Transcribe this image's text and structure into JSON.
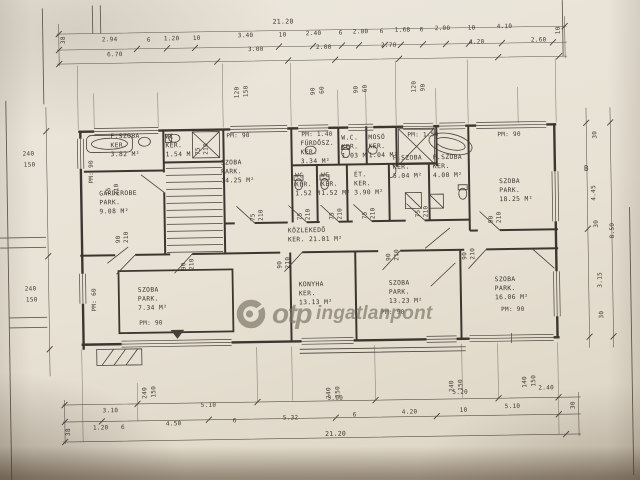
{
  "watermark": {
    "brand": "otp",
    "suffix": "ingatlanpont"
  },
  "plan": {
    "ink_color": "#3e3831",
    "paper_color": "#e8e2d5",
    "watermark_color": "#7b7565",
    "rooms": [
      {
        "name": "room-fszoba-382",
        "x": 112,
        "y": 129,
        "lines": [
          "F.SZOBA",
          "KER.",
          "3.82 M²"
        ]
      },
      {
        "name": "room-wc-154",
        "x": 167,
        "y": 130,
        "lines": [
          "WC",
          "KER.",
          "1.54 M"
        ]
      },
      {
        "name": "room-szoba-1425",
        "x": 222,
        "y": 157,
        "lines": [
          "SZOBA",
          "PARK.",
          "14.25 M²"
        ]
      },
      {
        "name": "room-garderobe",
        "x": 100,
        "y": 186,
        "lines": [
          "GARDEROBE",
          "PARK.",
          "9.08 M²"
        ]
      },
      {
        "name": "room-furdosz-334",
        "x": 302,
        "y": 139,
        "lines": [
          "FÜRDŐSZ.",
          "KER.",
          "3.34 M²"
        ]
      },
      {
        "name": "room-wc-103",
        "x": 343,
        "y": 134,
        "lines": [
          "W.C.",
          "KER.",
          "1.03 M"
        ]
      },
      {
        "name": "room-moso-104",
        "x": 370,
        "y": 134,
        "lines": [
          "MOSÓ",
          "KER.",
          "1.04 M²"
        ]
      },
      {
        "name": "room-fszoba-504",
        "x": 394,
        "y": 155,
        "lines": [
          "F.SZOBA",
          "KER.",
          "5.04 M²"
        ]
      },
      {
        "name": "room-fszoba-400",
        "x": 434,
        "y": 155,
        "lines": [
          "F.SZOBA",
          "KER.",
          "4.00 M²"
        ]
      },
      {
        "name": "room-szoba-1825",
        "x": 500,
        "y": 180,
        "lines": [
          "SZOBA",
          "PARK.",
          "18.25 M²"
        ]
      },
      {
        "name": "room-wc-152a",
        "x": 296,
        "y": 171,
        "lines": [
          "WC",
          "KER.",
          "1.52 M"
        ]
      },
      {
        "name": "room-wc-152b",
        "x": 322,
        "y": 171,
        "lines": [
          "WC",
          "KER.",
          "1.52 M²"
        ]
      },
      {
        "name": "room-et-390",
        "x": 355,
        "y": 171,
        "lines": [
          "ÉT.",
          "KER.",
          "3.90 M²"
        ]
      },
      {
        "name": "room-kozlekedo",
        "x": 288,
        "y": 226,
        "lines": [
          "KÖZLEKEDŐ",
          "KER. 21.01 M²"
        ]
      },
      {
        "name": "room-szoba-734",
        "x": 137,
        "y": 283,
        "lines": [
          "SZOBA",
          "PARK.",
          "7.34 M²"
        ]
      },
      {
        "name": "room-konyha",
        "x": 298,
        "y": 280,
        "lines": [
          "KONYHA",
          "KER.",
          "13.13 M²"
        ]
      },
      {
        "name": "room-szoba-1323",
        "x": 388,
        "y": 280,
        "lines": [
          "SZOBA",
          "PARK.",
          "13.23 M²"
        ]
      },
      {
        "name": "room-szoba-1606",
        "x": 494,
        "y": 278,
        "lines": [
          "SZOBA",
          "PARK.",
          "16.06 M²"
        ]
      }
    ],
    "dim_labels": [
      {
        "t": "21.20",
        "x": 276,
        "y": 17,
        "fs": 6.5
      },
      {
        "t": "38",
        "x": 63,
        "y": 40,
        "r": -90
      },
      {
        "t": "2.94",
        "x": 105,
        "y": 33
      },
      {
        "t": "6",
        "x": 150,
        "y": 34
      },
      {
        "t": "1.20",
        "x": 167,
        "y": 33
      },
      {
        "t": "10",
        "x": 196,
        "y": 33
      },
      {
        "t": "3.40",
        "x": 241,
        "y": 31
      },
      {
        "t": "10",
        "x": 282,
        "y": 31
      },
      {
        "t": "2.40",
        "x": 309,
        "y": 30
      },
      {
        "t": "6",
        "x": 342,
        "y": 30
      },
      {
        "t": "2.00",
        "x": 356,
        "y": 29
      },
      {
        "t": "6",
        "x": 383,
        "y": 29
      },
      {
        "t": "1.68",
        "x": 398,
        "y": 28
      },
      {
        "t": "6",
        "x": 423,
        "y": 28
      },
      {
        "t": "2.00",
        "x": 438,
        "y": 27
      },
      {
        "t": "10",
        "x": 471,
        "y": 27
      },
      {
        "t": "4.10",
        "x": 500,
        "y": 26
      },
      {
        "t": "10",
        "x": 558,
        "y": 38,
        "r": -90
      },
      {
        "t": "6.70",
        "x": 110,
        "y": 48
      },
      {
        "t": "3.00",
        "x": 251,
        "y": 45
      },
      {
        "t": "2.00",
        "x": 319,
        "y": 44
      },
      {
        "t": "2.70",
        "x": 384,
        "y": 43
      },
      {
        "t": "4.20",
        "x": 472,
        "y": 41
      },
      {
        "t": "2.60",
        "x": 534,
        "y": 40
      },
      {
        "t": "120",
        "x": 236,
        "y": 97,
        "r": -90
      },
      {
        "t": "150",
        "x": 245,
        "y": 96,
        "r": -90
      },
      {
        "t": "90",
        "x": 312,
        "y": 95,
        "r": -90
      },
      {
        "t": "60",
        "x": 321,
        "y": 94,
        "r": -90
      },
      {
        "t": "90",
        "x": 355,
        "y": 94,
        "r": -90
      },
      {
        "t": "60",
        "x": 364,
        "y": 93,
        "r": -90
      },
      {
        "t": "120",
        "x": 413,
        "y": 94,
        "r": -90
      },
      {
        "t": "90",
        "x": 422,
        "y": 93,
        "r": -90
      },
      {
        "t": "240",
        "x": 24,
        "y": 146
      },
      {
        "t": "150",
        "x": 25,
        "y": 157
      },
      {
        "t": "240",
        "x": 24,
        "y": 281
      },
      {
        "t": "150",
        "x": 25,
        "y": 292
      },
      {
        "t": "30",
        "x": 593,
        "y": 143,
        "r": -90
      },
      {
        "t": "B",
        "x": 585,
        "y": 168,
        "fs": 7.5
      },
      {
        "t": "4.45",
        "x": 591,
        "y": 205,
        "r": -90
      },
      {
        "t": "30",
        "x": 593,
        "y": 232,
        "r": -90
      },
      {
        "t": "8.50",
        "x": 609,
        "y": 243,
        "r": -90
      },
      {
        "t": "3.15",
        "x": 596,
        "y": 292,
        "r": -90
      },
      {
        "t": "30",
        "x": 597,
        "y": 323,
        "r": -90
      },
      {
        "t": "240",
        "x": 139,
        "y": 396,
        "r": -90
      },
      {
        "t": "150",
        "x": 148,
        "y": 395,
        "r": -90
      },
      {
        "t": "240",
        "x": 323,
        "y": 399,
        "r": -90
      },
      {
        "t": "150",
        "x": 332,
        "y": 398,
        "r": -90
      },
      {
        "t": "240",
        "x": 446,
        "y": 394,
        "r": -90
      },
      {
        "t": "150",
        "x": 455,
        "y": 393,
        "r": -90
      },
      {
        "t": "140",
        "x": 519,
        "y": 391,
        "r": -90
      },
      {
        "t": "150",
        "x": 528,
        "y": 390,
        "r": -90
      },
      {
        "t": "3.10",
        "x": 100,
        "y": 404
      },
      {
        "t": "5.10",
        "x": 198,
        "y": 400
      },
      {
        "t": "5.00",
        "x": 325,
        "y": 395
      },
      {
        "t": "5.20",
        "x": 450,
        "y": 391
      },
      {
        "t": "2.40",
        "x": 536,
        "y": 388
      },
      {
        "t": "38",
        "x": 62,
        "y": 432,
        "r": -90
      },
      {
        "t": "1.20",
        "x": 90,
        "y": 421
      },
      {
        "t": "6",
        "x": 118,
        "y": 421
      },
      {
        "t": "4.50",
        "x": 163,
        "y": 418
      },
      {
        "t": "6",
        "x": 230,
        "y": 416
      },
      {
        "t": "5.32",
        "x": 280,
        "y": 414
      },
      {
        "t": "6",
        "x": 350,
        "y": 412
      },
      {
        "t": "4.20",
        "x": 399,
        "y": 410
      },
      {
        "t": "10",
        "x": 457,
        "y": 409
      },
      {
        "t": "5.10",
        "x": 502,
        "y": 406
      },
      {
        "t": "30",
        "x": 567,
        "y": 413,
        "r": -90
      },
      {
        "t": "21.20",
        "x": 322,
        "y": 430,
        "fs": 6.5
      },
      {
        "t": "PM: 90",
        "x": 228,
        "y": 131,
        "n": "pm-label"
      },
      {
        "t": "PM: 1.40",
        "x": 303,
        "y": 131,
        "n": "pm-label"
      },
      {
        "t": "PM: 1.50",
        "x": 409,
        "y": 133,
        "n": "pm-label"
      },
      {
        "t": "PM: 90",
        "x": 499,
        "y": 134,
        "n": "pm-label"
      },
      {
        "t": "PM: 90",
        "x": 89,
        "y": 180,
        "r": -90,
        "n": "pm-label"
      },
      {
        "t": "PM: 60",
        "x": 90,
        "y": 308,
        "r": -90,
        "n": "pm-label"
      },
      {
        "t": "PM: 90",
        "x": 138,
        "y": 317,
        "n": "pm-label"
      },
      {
        "t": "PM: 90",
        "x": 380,
        "y": 310,
        "n": "pm-label"
      },
      {
        "t": "PM: 90",
        "x": 500,
        "y": 309,
        "n": "pm-label"
      },
      {
        "t": "75",
        "x": 196,
        "y": 153,
        "r": -90,
        "n": "door-size-label"
      },
      {
        "t": "210",
        "x": 204,
        "y": 153,
        "r": -90,
        "n": "door-size-label"
      },
      {
        "t": "75",
        "x": 106,
        "y": 192,
        "r": -90,
        "n": "door-size-label"
      },
      {
        "t": "210",
        "x": 114,
        "y": 192,
        "r": -90,
        "n": "door-size-label"
      },
      {
        "t": "90",
        "x": 115,
        "y": 240,
        "r": -90,
        "n": "door-size-label"
      },
      {
        "t": "210",
        "x": 123,
        "y": 240,
        "r": -90,
        "n": "door-size-label"
      },
      {
        "t": "75",
        "x": 250,
        "y": 220,
        "r": -90,
        "n": "door-size-label"
      },
      {
        "t": "210",
        "x": 258,
        "y": 220,
        "r": -90,
        "n": "door-size-label"
      },
      {
        "t": "75",
        "x": 297,
        "y": 220,
        "r": -90,
        "n": "door-size-label"
      },
      {
        "t": "210",
        "x": 305,
        "y": 220,
        "r": -90,
        "n": "door-size-label"
      },
      {
        "t": "75",
        "x": 329,
        "y": 220,
        "r": -90,
        "n": "door-size-label"
      },
      {
        "t": "210",
        "x": 337,
        "y": 220,
        "r": -90,
        "n": "door-size-label"
      },
      {
        "t": "75",
        "x": 362,
        "y": 220,
        "r": -90,
        "n": "door-size-label"
      },
      {
        "t": "210",
        "x": 370,
        "y": 220,
        "r": -90,
        "n": "door-size-label"
      },
      {
        "t": "75",
        "x": 415,
        "y": 219,
        "r": -90,
        "n": "door-size-label"
      },
      {
        "t": "210",
        "x": 423,
        "y": 219,
        "r": -90,
        "n": "door-size-label"
      },
      {
        "t": "90",
        "x": 488,
        "y": 226,
        "r": -90,
        "n": "door-size-label"
      },
      {
        "t": "210",
        "x": 496,
        "y": 226,
        "r": -90,
        "n": "door-size-label"
      },
      {
        "t": "90",
        "x": 180,
        "y": 268,
        "r": -90,
        "n": "door-size-label"
      },
      {
        "t": "210",
        "x": 188,
        "y": 268,
        "r": -90,
        "n": "door-size-label"
      },
      {
        "t": "90",
        "x": 276,
        "y": 268,
        "r": -90,
        "n": "door-size-label"
      },
      {
        "t": "210",
        "x": 284,
        "y": 268,
        "r": -90,
        "n": "door-size-label"
      },
      {
        "t": "90",
        "x": 385,
        "y": 262,
        "r": -90,
        "n": "door-size-label"
      },
      {
        "t": "210",
        "x": 393,
        "y": 262,
        "r": -90,
        "n": "door-size-label"
      },
      {
        "t": "90",
        "x": 461,
        "y": 262,
        "r": -90,
        "n": "door-size-label"
      },
      {
        "t": "210",
        "x": 469,
        "y": 262,
        "r": -90,
        "n": "door-size-label"
      }
    ]
  }
}
